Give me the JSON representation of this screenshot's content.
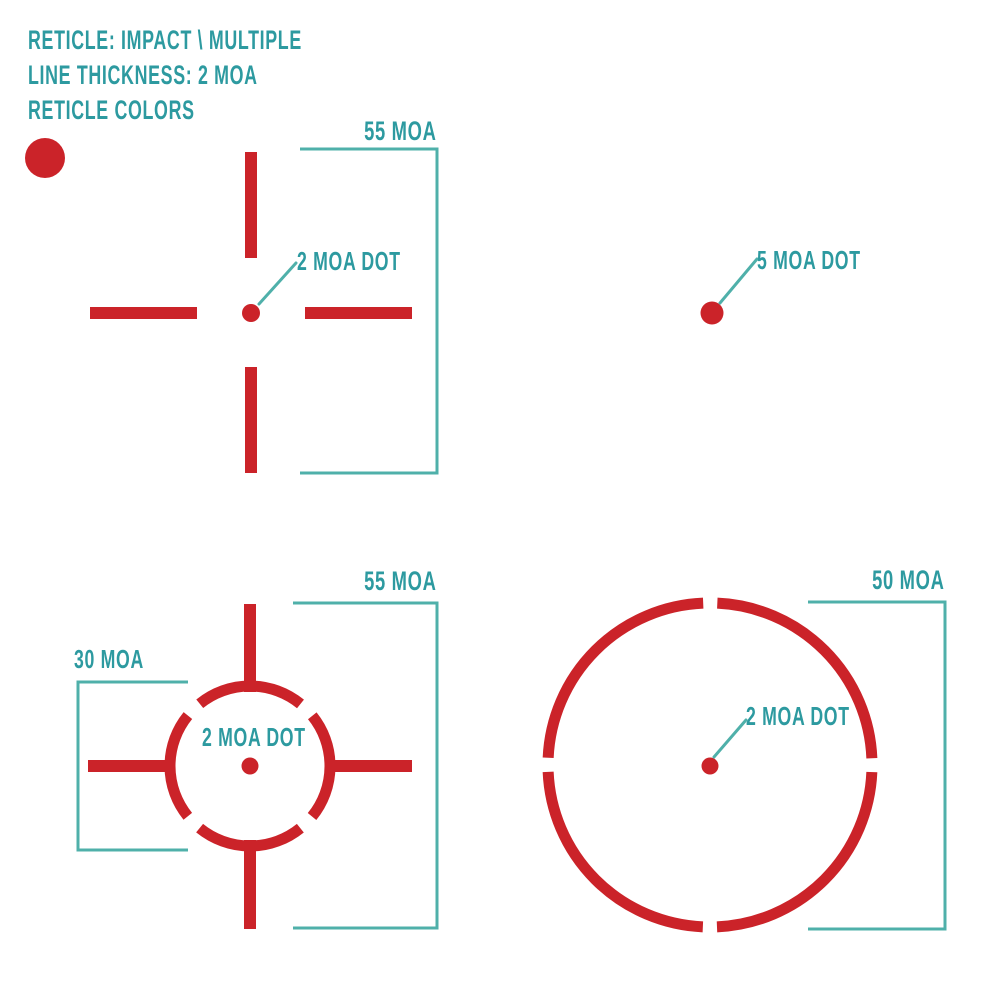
{
  "colors": {
    "background": "#ffffff",
    "red": "#cb2329",
    "teal_text": "#2d9aa0",
    "teal_line": "#4fb0aa"
  },
  "header": {
    "line1": "RETICLE: IMPACT \\ MULTIPLE",
    "line2": "LINE THICKNESS: 2 MOA",
    "line3": "RETICLE COLORS",
    "swatch": "red-dot"
  },
  "reticles": {
    "top_left": {
      "type": "crosshair-with-dot",
      "dot_label": "2 MOA DOT",
      "span_label": "55 MOA"
    },
    "top_right": {
      "type": "dot-only",
      "dot_label": "5 MOA DOT"
    },
    "bottom_left": {
      "type": "segmented-circle-crosshair-dot",
      "dot_label": "2 MOA DOT",
      "span_label": "55 MOA",
      "circle_label": "30 MOA"
    },
    "bottom_right": {
      "type": "segmented-circle-dot",
      "dot_label": "2 MOA DOT",
      "circle_label": "50 MOA"
    }
  }
}
